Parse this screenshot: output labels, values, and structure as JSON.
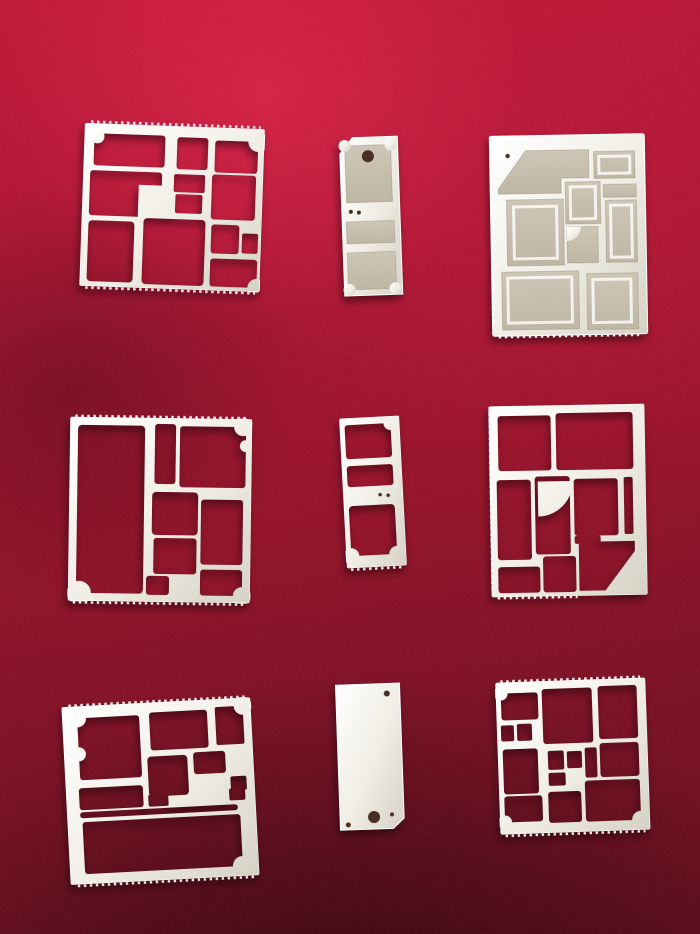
{
  "scene": {
    "description": "Nine precision stamped and etched metal RF/EMI shielding parts laid out in a 3 by 3 grid on crimson red velvet fabric",
    "background": "red velvet cloth, brighter at top, darkening toward the bottom corners",
    "item_count": 9,
    "grid": {
      "rows": 3,
      "cols": 3
    }
  },
  "colors": {
    "velvet-bright": "#c01637",
    "velvet-mid": "#951128",
    "velvet-dark": "#640c1c",
    "metal-hi": "#ffffff",
    "metal": "#efede4",
    "metal-shade": "#d5d1c5",
    "panel": "#cdc6b6",
    "panel-dark": "#bfb7a4",
    "hole-dark": "#4a2d24"
  },
  "items": [
    {
      "id": "frame-large-a",
      "grid": {
        "row": 1,
        "col": 1
      },
      "type": "shield frame",
      "label": "Large square shield frame with about twelve rectangular through-openings, corner scallop notches and serrated solder edges"
    },
    {
      "id": "cover-small",
      "grid": {
        "row": 1,
        "col": 2
      },
      "type": "shield cover",
      "label": "Small rectangular shield cover with chamfered top corner, three recessed panels, one round pilot hole and two micro holes"
    },
    {
      "id": "cover-large",
      "grid": {
        "row": 1,
        "col": 3
      },
      "type": "shield cover",
      "label": "Large rectangular shield cover with etched recessed compartments, one pocket with a 45 degree chamfer and a quarter-round feature"
    },
    {
      "id": "frame-large-b",
      "grid": {
        "row": 2,
        "col": 1
      },
      "type": "shield frame",
      "label": "Square shield frame with one tall full-height opening and seven smaller rectangular openings with scalloped notches"
    },
    {
      "id": "frame-small",
      "grid": {
        "row": 2,
        "col": 2
      },
      "type": "shield frame",
      "label": "Small vertical shield frame with three through-openings and rounded scallop corners"
    },
    {
      "id": "frame-large-c",
      "grid": {
        "row": 2,
        "col": 3
      },
      "type": "shield frame",
      "label": "Rectangular shield frame with nine openings, a quarter-circle web feature and a solid diagonal bottom-right corner"
    },
    {
      "id": "frame-large-d",
      "grid": {
        "row": 3,
        "col": 1
      },
      "type": "shield frame",
      "label": "Square shield frame with scalloped top-left opening, long narrow slot and one wide bottom opening"
    },
    {
      "id": "plate-blank",
      "grid": {
        "row": 3,
        "col": 2
      },
      "type": "blank cover plate",
      "label": "Solid blank metal plate with one large and two small round holes and a clipped bottom-right corner"
    },
    {
      "id": "frame-large-e",
      "grid": {
        "row": 3,
        "col": 3
      },
      "type": "shield frame",
      "label": "Square shield frame with fourteen mixed-size rectangular openings and corner scallop notches"
    }
  ]
}
